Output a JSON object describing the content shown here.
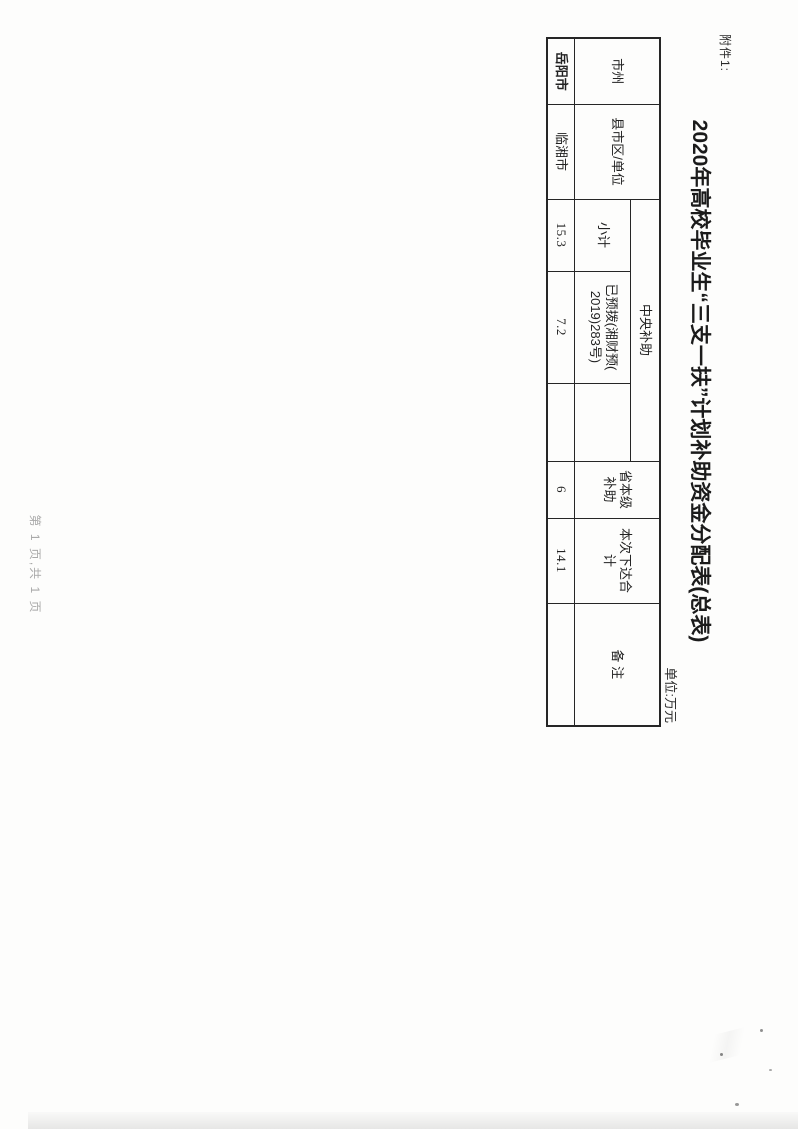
{
  "colors": {
    "highlight_pink": "#e679ab",
    "ink": "#222222",
    "footer_gray": "#a9a9a9"
  },
  "page": {
    "attachment_label": "附件1:",
    "title": "2020年高校毕业生“三支一扶”计划补助资金分配表(总表)",
    "unit_label": "单位:万元",
    "footer_page_info": "第 1 页,共 1 页"
  },
  "table": {
    "headers": {
      "city": "市州",
      "county": "县市区/单位",
      "central_group": "中央补助",
      "subtotal": "小计",
      "pre_allocated": "已预拨(湘财预(\n2019)283号)",
      "blank_sub": "",
      "provincial": "省本级\n补助",
      "current_total": "本次下达合\n计",
      "remarks": "备 注"
    },
    "rows": [
      {
        "city": "岳阳市",
        "county": "临湘市",
        "subtotal": "15.3",
        "pre_allocated": "7.2",
        "blank": "",
        "provincial": "6",
        "current_total": "14.1",
        "remarks": ""
      }
    ]
  }
}
